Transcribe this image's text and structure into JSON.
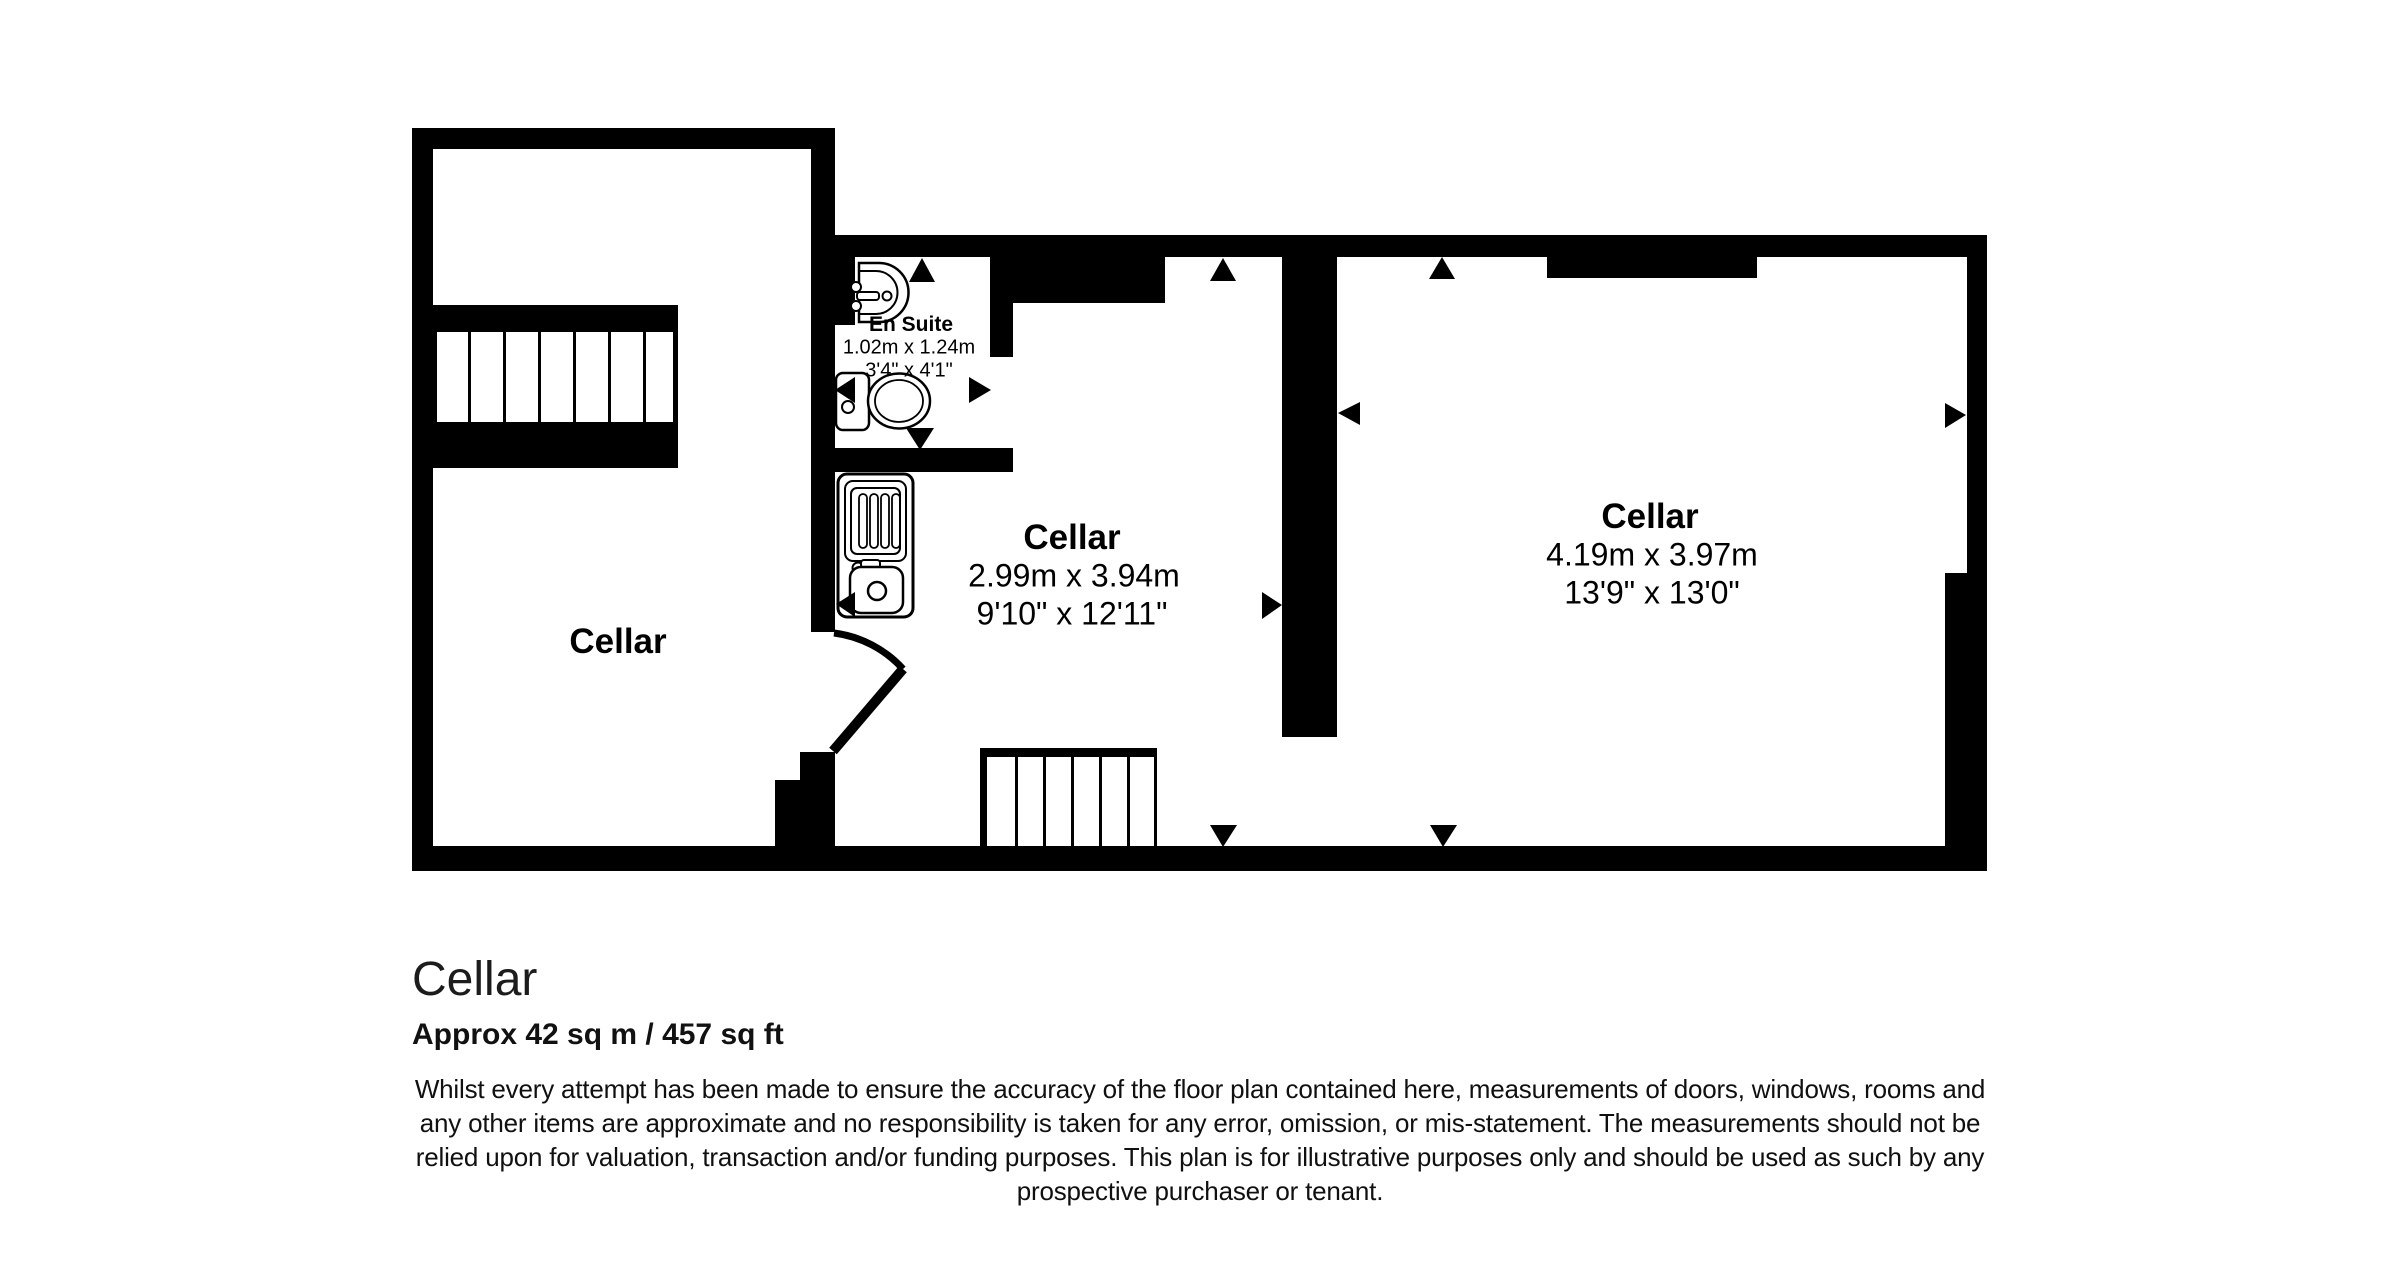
{
  "plan": {
    "colors": {
      "wall": "#000000",
      "background": "#ffffff",
      "text": "#000000"
    },
    "rooms": {
      "left": {
        "label": "Cellar"
      },
      "middle": {
        "label": "Cellar",
        "metric": "2.99m x 3.94m",
        "imperial": "9'10\" x 12'11\""
      },
      "right": {
        "label": "Cellar",
        "metric": "4.19m x 3.97m",
        "imperial": "13'9\" x 13'0\""
      },
      "ensuite": {
        "label": "En Suite",
        "metric": "1.02m x 1.24m",
        "imperial": "3'4\" x 4'1\""
      }
    },
    "fixtures": {
      "basin": "wash-basin",
      "toilet": "toilet",
      "sink": "kitchen-sink-unit",
      "stairs_upper": "staircase",
      "stairs_lower": "staircase",
      "door": "door-swing"
    }
  },
  "footer": {
    "title": "Cellar",
    "area": "Approx 42 sq m / 457 sq ft",
    "disclaimer": [
      "Whilst every attempt has been made to ensure the accuracy of the floor plan contained here, measurements of doors, windows, rooms and",
      "any other items are approximate and no responsibility is taken for any error, omission, or mis-statement. The measurements should not be",
      "relied upon for valuation, transaction and/or funding purposes. This plan is for illustrative purposes only and should be used as such by any",
      "prospective purchaser or tenant."
    ]
  }
}
